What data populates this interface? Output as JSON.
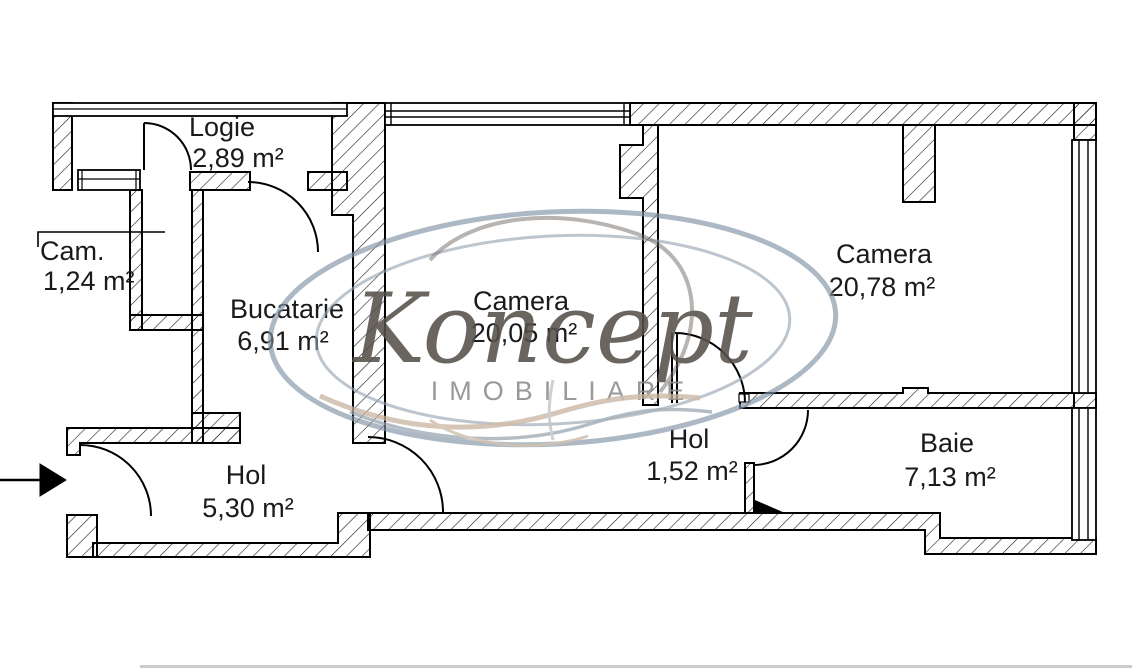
{
  "plan": {
    "title": "apartment-floor-plan",
    "rooms": [
      {
        "name": "Logie",
        "area": "2,89 m²"
      },
      {
        "name": "Cam.",
        "area": "1,24 m²"
      },
      {
        "name": "Bucatarie",
        "area": "6,91 m²"
      },
      {
        "name": "Camera",
        "area": "20,05 m²"
      },
      {
        "name": "Camera",
        "area": "20,78 m²"
      },
      {
        "name": "Hol",
        "area": "5,30 m²"
      },
      {
        "name": "Hol",
        "area": "1,52 m²"
      },
      {
        "name": "Baie",
        "area": "7,13 m²"
      }
    ]
  },
  "watermark": {
    "brand": "Koncept",
    "tagline": "IMOBILIARE"
  },
  "colors": {
    "wall": "#000000",
    "text": "#1a1a1a",
    "watermark_blue": "#8094a6",
    "watermark_script": "#56504a",
    "watermark_tan": "#c7b3a0",
    "watermark_gray": "#8c8c8c"
  }
}
